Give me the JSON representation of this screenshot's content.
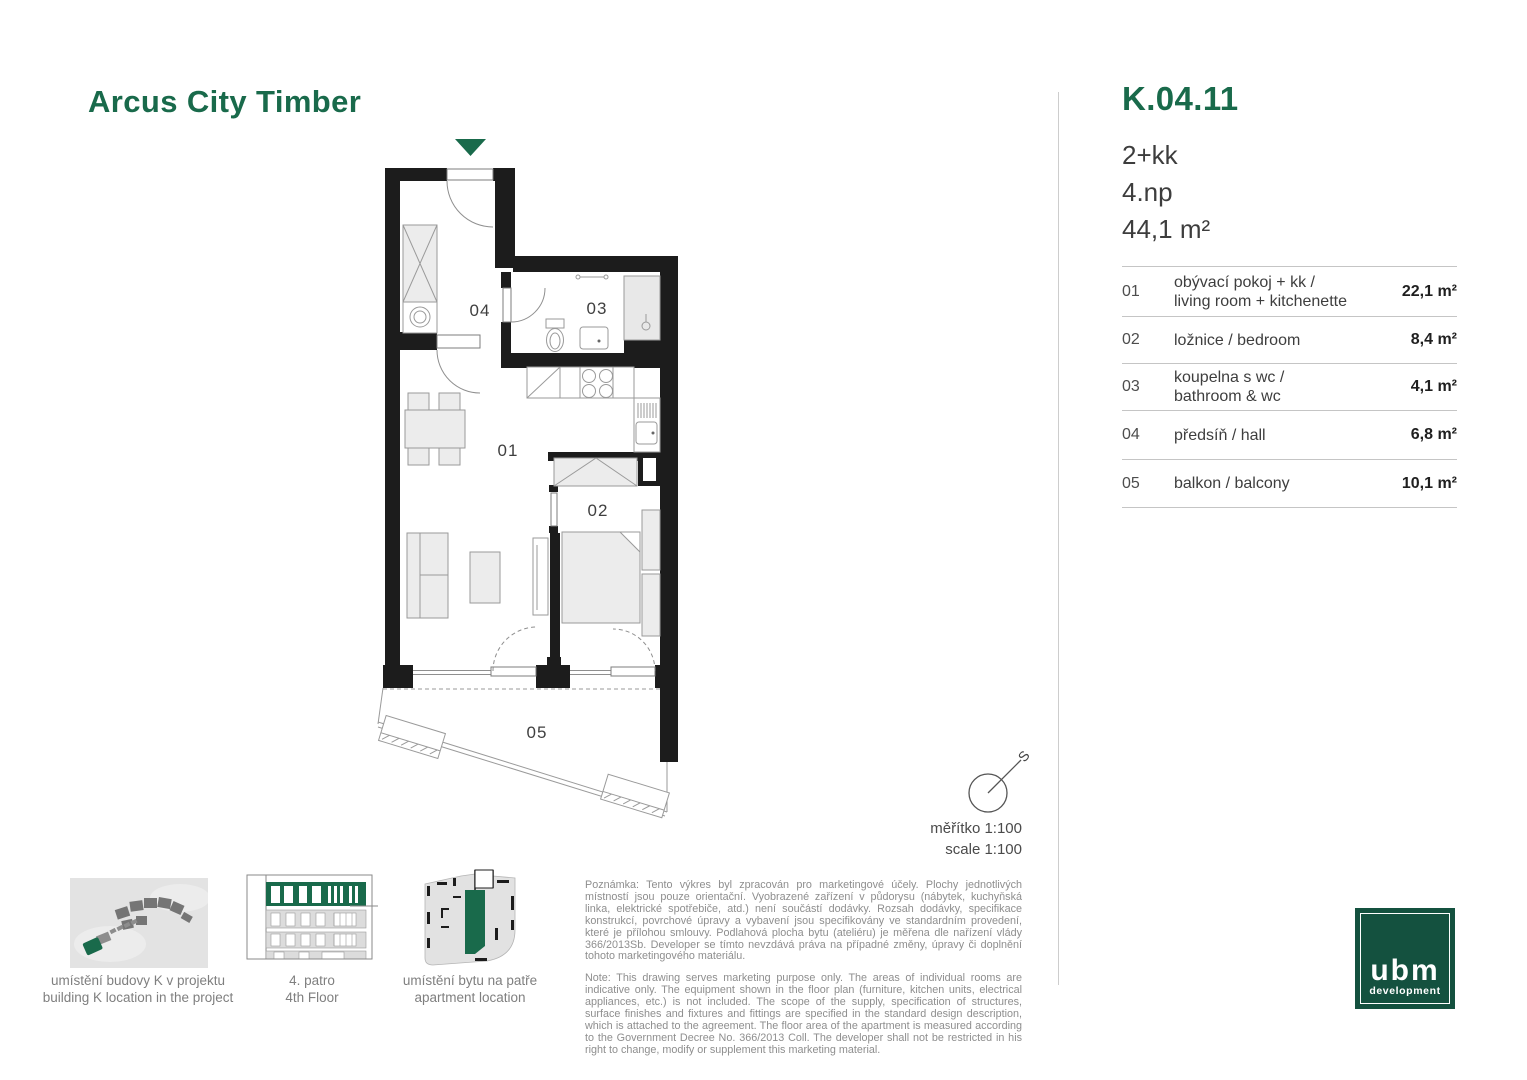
{
  "header": {
    "project_title": "Arcus City Timber"
  },
  "unit": {
    "code": "K.04.11",
    "disposition": "2+kk",
    "floor": "4.np",
    "area": "44,1 m²"
  },
  "rooms": [
    {
      "num": "01",
      "line1": "obývací pokoj + kk /",
      "line2": "living room + kitchenette",
      "area": "22,1 m²"
    },
    {
      "num": "02",
      "line1": "ložnice / bedroom",
      "area": "8,4 m²"
    },
    {
      "num": "03",
      "line1": "koupelna s wc /",
      "line2": "bathroom & wc",
      "area": "4,1 m²"
    },
    {
      "num": "04",
      "line1": "předsíň / hall",
      "area": "6,8 m²"
    },
    {
      "num": "05",
      "line1": "balkon / balcony",
      "area": "10,1 m²"
    }
  ],
  "compass": {
    "north": "S"
  },
  "scale": {
    "cs": "měřítko 1:100",
    "en": "scale 1:100"
  },
  "thumbnails": {
    "site": {
      "caption1": "umístění budovy K v projektu",
      "caption2": "building K location in the project"
    },
    "elevation": {
      "caption1": "4. patro",
      "caption2": "4th Floor"
    },
    "floorplate": {
      "caption1": "umístění bytu na patře",
      "caption2": "apartment location"
    }
  },
  "disclaimer": {
    "cs": "Poznámka: Tento výkres byl zpracován pro marketingové účely. Plochy jednotlivých místností jsou pouze orientační. Vyobrazené zařízení v půdorysu (nábytek, kuchyňská linka, elektrické spotřebiče, atd.) není součástí dodávky. Rozsah dodávky, specifikace konstrukcí, povrchové úpravy a vybavení jsou specifikovány ve standardním provedení, které je přílohou smlouvy. Podlahová plocha bytu (ateliéru) je měřena dle nařízení vlády 366/2013Sb. Developer se tímto nevzdává práva na případné změny, úpravy či doplnění tohoto marketingového materiálu.",
    "en": "Note: This drawing serves marketing purpose only. The areas of individual rooms are indicative only. The equipment shown in the floor plan (furniture, kitchen units, electrical appliances, etc.) is not included. The scope of the supply, specification of structures, surface finishes and fixtures and fittings are specified in the standard design description, which is attached to the agreement. The floor area of the apartment is measured according to the Government Decree No. 366/2013 Coll. The developer shall not be restricted in his right to change, modify or supplement this marketing material."
  },
  "logo": {
    "brand": "ubm",
    "tagline": "development"
  },
  "colors": {
    "green": "#196A4B",
    "logo_green": "#14513F"
  }
}
